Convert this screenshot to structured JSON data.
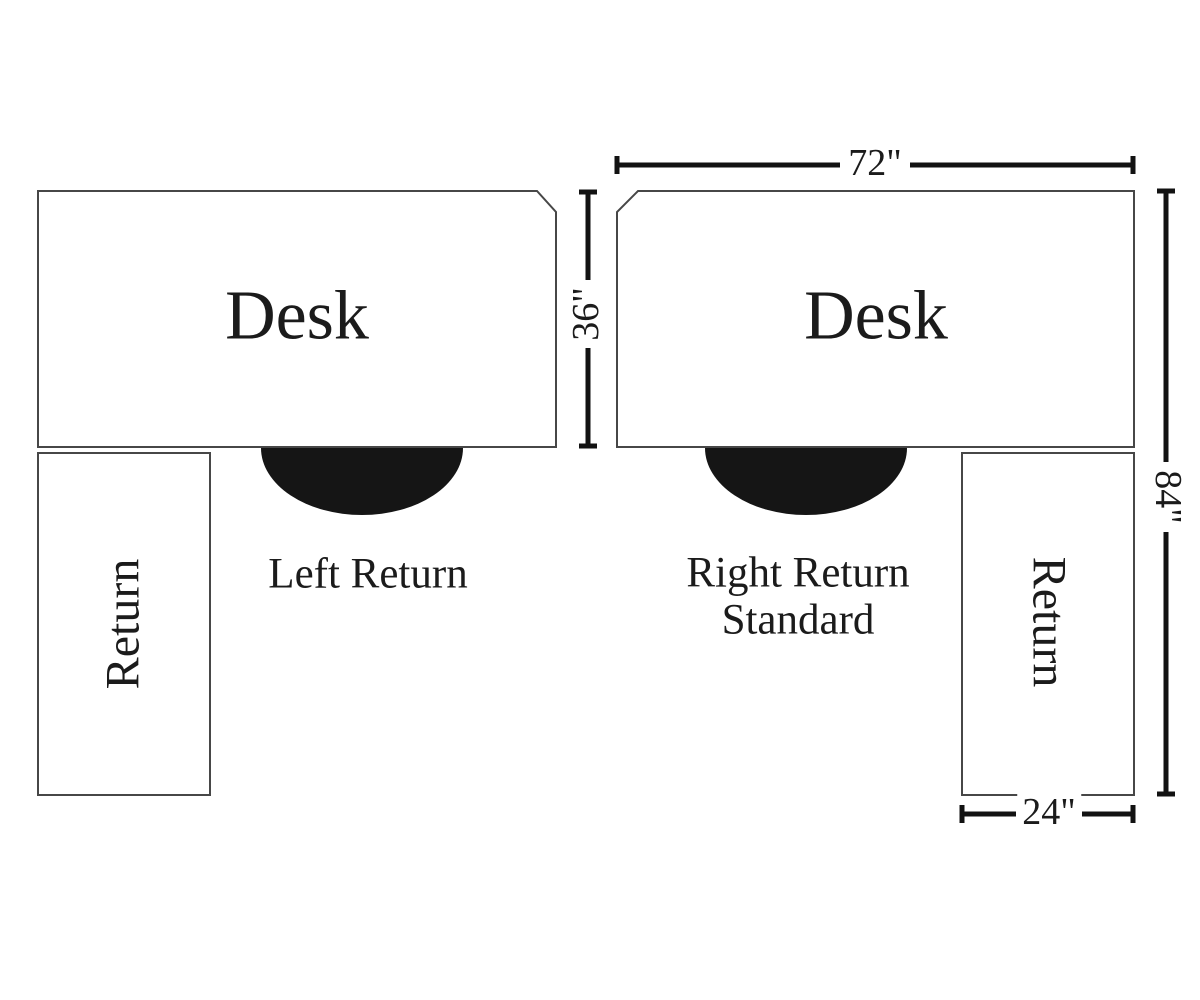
{
  "diagram": {
    "colors": {
      "background": "#ffffff",
      "outline": "#474747",
      "dimension": "#121212",
      "chair": "#151515",
      "text": "#1b1b1b"
    },
    "left": {
      "desk_label": "Desk",
      "return_label": "Return",
      "caption": "Left Return",
      "depth_dim": "36\""
    },
    "right": {
      "desk_label": "Desk",
      "return_label": "Return",
      "caption_line1": "Right Return",
      "caption_line2": "Standard",
      "width_dim": "72\"",
      "total_depth_dim": "84\"",
      "return_width_dim": "24\""
    }
  }
}
